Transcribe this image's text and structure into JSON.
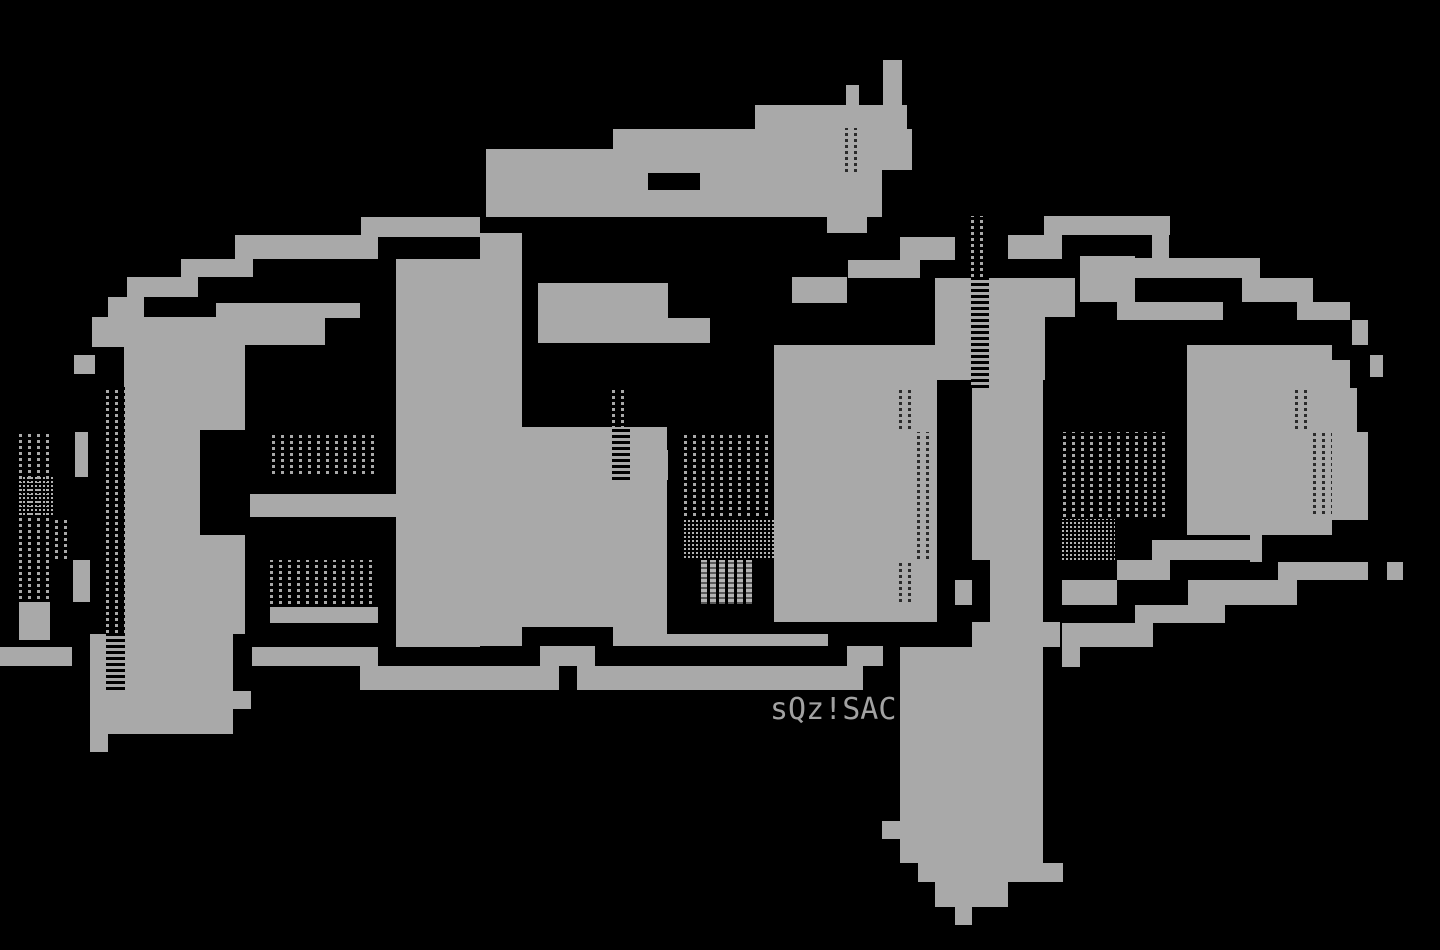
{
  "artwork": {
    "kind": "ansi-ascii-art-logo",
    "background_color": "#000000",
    "ink_color": "#a9a9a9",
    "signature": {
      "text": "sQz!SAC",
      "color": "#a2a2a2"
    },
    "blocks": [
      {
        "name": "a-top-bar-1",
        "x": 361,
        "y": 217,
        "w": 119,
        "h": 20,
        "fill": "ink"
      },
      {
        "name": "a-top-bar-2",
        "x": 235,
        "y": 235,
        "w": 143,
        "h": 24,
        "fill": "ink"
      },
      {
        "name": "a-top-bar-3",
        "x": 181,
        "y": 259,
        "w": 72,
        "h": 18,
        "fill": "ink"
      },
      {
        "name": "a-top-bar-4",
        "x": 127,
        "y": 277,
        "w": 71,
        "h": 20,
        "fill": "ink"
      },
      {
        "name": "a-top-bar-5",
        "x": 108,
        "y": 297,
        "w": 36,
        "h": 50,
        "fill": "ink"
      },
      {
        "name": "a-top-bar-6",
        "x": 216,
        "y": 303,
        "w": 144,
        "h": 15,
        "fill": "ink"
      },
      {
        "name": "a-shoulder",
        "x": 110,
        "y": 317,
        "w": 215,
        "h": 28,
        "fill": "ink"
      },
      {
        "name": "a-edge-1",
        "x": 92,
        "y": 317,
        "w": 18,
        "h": 30,
        "fill": "ink"
      },
      {
        "name": "a-edge-2",
        "x": 74,
        "y": 355,
        "w": 21,
        "h": 19,
        "fill": "ink"
      },
      {
        "name": "a-edge-3",
        "x": 75,
        "y": 432,
        "w": 13,
        "h": 45,
        "fill": "ink"
      },
      {
        "name": "a-edge-4",
        "x": 73,
        "y": 560,
        "w": 17,
        "h": 42,
        "fill": "ink"
      },
      {
        "name": "a-foot-left",
        "x": 19,
        "y": 602,
        "w": 31,
        "h": 38,
        "fill": "ink"
      },
      {
        "name": "a-fill-left-1",
        "x": 124,
        "y": 345,
        "w": 121,
        "h": 85,
        "fill": "ink"
      },
      {
        "name": "a-fill-left-2",
        "x": 124,
        "y": 430,
        "w": 76,
        "h": 105,
        "fill": "ink"
      },
      {
        "name": "a-fill-left-3",
        "x": 124,
        "y": 535,
        "w": 121,
        "h": 99,
        "fill": "ink"
      },
      {
        "name": "a-band-mid",
        "x": 250,
        "y": 494,
        "w": 146,
        "h": 23,
        "fill": "ink"
      },
      {
        "name": "a-band-low",
        "x": 270,
        "y": 607,
        "w": 108,
        "h": 16,
        "fill": "ink"
      },
      {
        "name": "a-fill-right",
        "x": 396,
        "y": 317,
        "w": 84,
        "h": 330,
        "fill": "ink"
      },
      {
        "name": "a-right-upper",
        "x": 396,
        "y": 259,
        "w": 84,
        "h": 58,
        "fill": "ink"
      },
      {
        "name": "a-bottom-blob",
        "x": 90,
        "y": 634,
        "w": 143,
        "h": 100,
        "fill": "ink"
      },
      {
        "name": "a-bottom-step",
        "x": 198,
        "y": 691,
        "w": 53,
        "h": 18,
        "fill": "ink"
      },
      {
        "name": "a-bottom-foot",
        "x": 90,
        "y": 734,
        "w": 18,
        "h": 18,
        "fill": "ink"
      },
      {
        "name": "bottom-bar-left",
        "x": 0,
        "y": 647,
        "w": 72,
        "h": 19,
        "fill": "ink"
      },
      {
        "name": "bottom-bar-mid",
        "x": 252,
        "y": 647,
        "w": 126,
        "h": 19,
        "fill": "ink"
      },
      {
        "name": "bottom-bar-main",
        "x": 360,
        "y": 666,
        "w": 503,
        "h": 24,
        "fill": "ink"
      },
      {
        "name": "bottom-bar-top-1",
        "x": 396,
        "y": 634,
        "w": 84,
        "h": 13,
        "fill": "ink"
      },
      {
        "name": "bottom-bar-top-2",
        "x": 613,
        "y": 634,
        "w": 215,
        "h": 12,
        "fill": "ink"
      },
      {
        "name": "bottom-bar-top-3",
        "x": 540,
        "y": 646,
        "w": 55,
        "h": 20,
        "fill": "ink"
      },
      {
        "name": "bottom-bar-top-4",
        "x": 847,
        "y": 646,
        "w": 36,
        "h": 20,
        "fill": "ink"
      },
      {
        "name": "bottom-bar-top-5",
        "x": 480,
        "y": 634,
        "w": 42,
        "h": 12,
        "fill": "ink"
      },
      {
        "name": "five-tip",
        "x": 883,
        "y": 60,
        "w": 19,
        "h": 25,
        "fill": "ink"
      },
      {
        "name": "five-tip-2",
        "x": 846,
        "y": 85,
        "w": 56,
        "h": 20,
        "fill": "ink"
      },
      {
        "name": "five-flag-1",
        "x": 755,
        "y": 105,
        "w": 152,
        "h": 24,
        "fill": "ink"
      },
      {
        "name": "five-flag-2",
        "x": 613,
        "y": 129,
        "w": 299,
        "h": 41,
        "fill": "ink"
      },
      {
        "name": "five-flag-3",
        "x": 486,
        "y": 149,
        "w": 426,
        "h": 21,
        "fill": "ink"
      },
      {
        "name": "five-flag-4",
        "x": 486,
        "y": 170,
        "w": 396,
        "h": 47,
        "fill": "ink"
      },
      {
        "name": "five-step",
        "x": 827,
        "y": 217,
        "w": 40,
        "h": 16,
        "fill": "ink"
      },
      {
        "name": "five-column",
        "x": 480,
        "y": 233,
        "w": 42,
        "h": 247,
        "fill": "ink"
      },
      {
        "name": "five-midband",
        "x": 538,
        "y": 283,
        "w": 130,
        "h": 60,
        "fill": "ink"
      },
      {
        "name": "five-midband-2",
        "x": 668,
        "y": 318,
        "w": 42,
        "h": 25,
        "fill": "ink"
      },
      {
        "name": "five-mass",
        "x": 480,
        "y": 427,
        "w": 187,
        "h": 207,
        "fill": "ink"
      },
      {
        "name": "five-step-2",
        "x": 630,
        "y": 450,
        "w": 38,
        "h": 30,
        "fill": "ink"
      },
      {
        "name": "five-wall",
        "x": 774,
        "y": 345,
        "w": 163,
        "h": 277,
        "fill": "ink"
      },
      {
        "name": "five-wall-up-1",
        "x": 792,
        "y": 277,
        "w": 55,
        "h": 26,
        "fill": "ink"
      },
      {
        "name": "five-wall-up-2",
        "x": 848,
        "y": 260,
        "w": 72,
        "h": 18,
        "fill": "ink"
      },
      {
        "name": "five-wall-up-3",
        "x": 900,
        "y": 237,
        "w": 55,
        "h": 23,
        "fill": "ink"
      },
      {
        "name": "gap-piece",
        "x": 955,
        "y": 580,
        "w": 17,
        "h": 25,
        "fill": "ink"
      },
      {
        "name": "p-top-1",
        "x": 1044,
        "y": 216,
        "w": 126,
        "h": 19,
        "fill": "ink"
      },
      {
        "name": "p-top-2",
        "x": 1008,
        "y": 235,
        "w": 54,
        "h": 24,
        "fill": "ink"
      },
      {
        "name": "p-top-3",
        "x": 1152,
        "y": 235,
        "w": 17,
        "h": 24,
        "fill": "ink"
      },
      {
        "name": "p-top-4",
        "x": 1080,
        "y": 256,
        "w": 55,
        "h": 46,
        "fill": "ink"
      },
      {
        "name": "p-top-5",
        "x": 1135,
        "y": 258,
        "w": 125,
        "h": 20,
        "fill": "ink"
      },
      {
        "name": "p-top-6",
        "x": 1117,
        "y": 302,
        "w": 106,
        "h": 18,
        "fill": "ink"
      },
      {
        "name": "p-top-7",
        "x": 1242,
        "y": 278,
        "w": 71,
        "h": 24,
        "fill": "ink"
      },
      {
        "name": "p-top-8",
        "x": 1297,
        "y": 302,
        "w": 53,
        "h": 18,
        "fill": "ink"
      },
      {
        "name": "p-stem-top",
        "x": 935,
        "y": 278,
        "w": 140,
        "h": 39,
        "fill": "ink"
      },
      {
        "name": "p-stem-2",
        "x": 935,
        "y": 317,
        "w": 110,
        "h": 63,
        "fill": "ink"
      },
      {
        "name": "p-stem-3",
        "x": 972,
        "y": 380,
        "w": 71,
        "h": 180,
        "fill": "ink"
      },
      {
        "name": "p-stem-4",
        "x": 990,
        "y": 560,
        "w": 53,
        "h": 62,
        "fill": "ink"
      },
      {
        "name": "p-stem-5",
        "x": 972,
        "y": 622,
        "w": 88,
        "h": 25,
        "fill": "ink"
      },
      {
        "name": "p-descender-1",
        "x": 900,
        "y": 647,
        "w": 143,
        "h": 174,
        "fill": "ink"
      },
      {
        "name": "p-descender-notch",
        "x": 882,
        "y": 821,
        "w": 20,
        "h": 18,
        "fill": "ink"
      },
      {
        "name": "p-descender-2",
        "x": 900,
        "y": 821,
        "w": 143,
        "h": 42,
        "fill": "ink"
      },
      {
        "name": "p-descender-3",
        "x": 918,
        "y": 863,
        "w": 145,
        "h": 19,
        "fill": "ink"
      },
      {
        "name": "p-descender-4",
        "x": 935,
        "y": 882,
        "w": 73,
        "h": 25,
        "fill": "ink"
      },
      {
        "name": "p-descender-5",
        "x": 955,
        "y": 907,
        "w": 17,
        "h": 18,
        "fill": "ink"
      },
      {
        "name": "p-bowl-top",
        "x": 1187,
        "y": 345,
        "w": 145,
        "h": 80,
        "fill": "ink"
      },
      {
        "name": "p-bowl-right-1",
        "x": 1332,
        "y": 360,
        "w": 18,
        "h": 28,
        "fill": "ink"
      },
      {
        "name": "p-bowl-right-2",
        "x": 1332,
        "y": 388,
        "w": 25,
        "h": 44,
        "fill": "ink"
      },
      {
        "name": "p-bowl-right-3",
        "x": 1332,
        "y": 432,
        "w": 36,
        "h": 88,
        "fill": "ink"
      },
      {
        "name": "p-bowl-fill-1",
        "x": 1250,
        "y": 425,
        "w": 82,
        "h": 110,
        "fill": "ink"
      },
      {
        "name": "p-bowl-fill-2",
        "x": 1187,
        "y": 425,
        "w": 63,
        "h": 110,
        "fill": "ink"
      },
      {
        "name": "p-bowl-fill-3",
        "x": 1250,
        "y": 535,
        "w": 12,
        "h": 27,
        "fill": "ink"
      },
      {
        "name": "p-bowl-bot-1",
        "x": 1152,
        "y": 540,
        "w": 106,
        "h": 20,
        "fill": "ink"
      },
      {
        "name": "p-bowl-bot-2",
        "x": 1117,
        "y": 560,
        "w": 53,
        "h": 20,
        "fill": "ink"
      },
      {
        "name": "p-bowl-bot-3",
        "x": 1062,
        "y": 580,
        "w": 55,
        "h": 25,
        "fill": "ink"
      },
      {
        "name": "p-bowl-bot-4",
        "x": 1278,
        "y": 562,
        "w": 90,
        "h": 18,
        "fill": "ink"
      },
      {
        "name": "p-bowl-bot-5",
        "x": 1387,
        "y": 562,
        "w": 16,
        "h": 18,
        "fill": "ink"
      },
      {
        "name": "p-bowl-bot-6",
        "x": 1188,
        "y": 580,
        "w": 109,
        "h": 25,
        "fill": "ink"
      },
      {
        "name": "p-bowl-bot-7",
        "x": 1135,
        "y": 605,
        "w": 90,
        "h": 18,
        "fill": "ink"
      },
      {
        "name": "p-bowl-bot-8",
        "x": 1062,
        "y": 623,
        "w": 91,
        "h": 24,
        "fill": "ink"
      },
      {
        "name": "p-bowl-foot",
        "x": 1062,
        "y": 647,
        "w": 18,
        "h": 20,
        "fill": "ink"
      },
      {
        "name": "p-outer-1",
        "x": 1352,
        "y": 320,
        "w": 16,
        "h": 25,
        "fill": "ink"
      },
      {
        "name": "p-outer-2",
        "x": 1370,
        "y": 355,
        "w": 13,
        "h": 22,
        "fill": "ink"
      },
      {
        "name": "notch-flag",
        "x": 859,
        "y": 85,
        "w": 24,
        "h": 20,
        "fill": "black"
      },
      {
        "name": "notch-band",
        "x": 648,
        "y": 173,
        "w": 52,
        "h": 17,
        "fill": "black"
      },
      {
        "name": "notch-mass",
        "x": 522,
        "y": 627,
        "w": 91,
        "h": 19,
        "fill": "black"
      },
      {
        "name": "notch-bar",
        "x": 559,
        "y": 666,
        "w": 18,
        "h": 24,
        "fill": "black"
      },
      {
        "name": "tex-a-upper",
        "x": 272,
        "y": 432,
        "w": 105,
        "h": 45,
        "fill": "dots"
      },
      {
        "name": "tex-a-lower",
        "x": 270,
        "y": 560,
        "w": 107,
        "h": 47,
        "fill": "dots"
      },
      {
        "name": "tex-left-1",
        "x": 19,
        "y": 433,
        "w": 35,
        "h": 169,
        "fill": "dots"
      },
      {
        "name": "tex-left-checker",
        "x": 19,
        "y": 477,
        "w": 35,
        "h": 40,
        "fill": "checker"
      },
      {
        "name": "tex-left-2",
        "x": 55,
        "y": 517,
        "w": 14,
        "h": 45,
        "fill": "dots"
      },
      {
        "name": "tex-left-3",
        "x": 106,
        "y": 387,
        "w": 19,
        "h": 303,
        "fill": "dots"
      },
      {
        "name": "tex-five-col",
        "x": 612,
        "y": 387,
        "w": 18,
        "h": 93,
        "fill": "dots"
      },
      {
        "name": "tex-five-big",
        "x": 684,
        "y": 432,
        "w": 90,
        "h": 87,
        "fill": "dots"
      },
      {
        "name": "tex-five-checker",
        "x": 684,
        "y": 519,
        "w": 90,
        "h": 41,
        "fill": "checker"
      },
      {
        "name": "tex-five-light",
        "x": 701,
        "y": 560,
        "w": 54,
        "h": 44,
        "fill": "light"
      },
      {
        "name": "tex-p-stem",
        "x": 971,
        "y": 216,
        "w": 18,
        "h": 172,
        "fill": "dots"
      },
      {
        "name": "tex-p-big",
        "x": 1063,
        "y": 432,
        "w": 107,
        "h": 88,
        "fill": "dots"
      },
      {
        "name": "tex-p-checker",
        "x": 1062,
        "y": 519,
        "w": 53,
        "h": 43,
        "fill": "checker"
      },
      {
        "name": "tex-flag",
        "x": 845,
        "y": 128,
        "w": 18,
        "h": 47,
        "fill": "dark-dots"
      },
      {
        "name": "tex-wall-1",
        "x": 899,
        "y": 390,
        "w": 18,
        "h": 42,
        "fill": "dark-dots"
      },
      {
        "name": "tex-wall-2",
        "x": 917,
        "y": 432,
        "w": 18,
        "h": 130,
        "fill": "dark-dots"
      },
      {
        "name": "tex-wall-3",
        "x": 899,
        "y": 560,
        "w": 18,
        "h": 45,
        "fill": "dark-dots"
      },
      {
        "name": "tex-bowl-r1",
        "x": 1295,
        "y": 388,
        "w": 18,
        "h": 44,
        "fill": "dark-dots"
      },
      {
        "name": "tex-bowl-r2",
        "x": 1313,
        "y": 432,
        "w": 19,
        "h": 85,
        "fill": "dark-dots"
      }
    ]
  }
}
